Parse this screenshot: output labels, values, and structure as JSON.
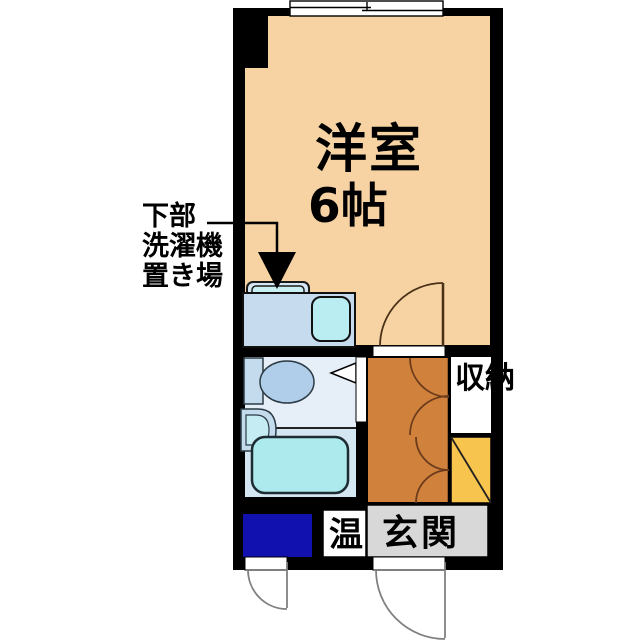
{
  "rooms": {
    "main_room": {
      "name": "洋室",
      "size": "6帖"
    },
    "storage_label": "収納",
    "entrance_label": "玄関",
    "water_heater_label": "温"
  },
  "annotation": {
    "line1": "下部",
    "line2": "洗濯機",
    "line3": "置き場"
  },
  "colors": {
    "wall": "#000000",
    "room_floor": "#F7D3A3",
    "hallway_floor": "#D0813C",
    "shoe_cabinet": "#F7C44D",
    "doormat": "#1111AF",
    "entrance_floor": "#D8D8D8",
    "counter": "#C7DBEE",
    "sink": "#B9EDF1",
    "washer": "#C9EFF2",
    "washer_pan": "#D5E7F2",
    "bathroom_upper": "#E6EFF7",
    "bathroom_lower": "#D3E6F1",
    "bathtub": "#ACEAEE",
    "toilet_bowl": "#B0CDE9",
    "toilet_tank": "#C3DBEC",
    "basin_inner": "#C5ECF2",
    "window_fill": "#FFFFFF",
    "door_line": "#4A3017",
    "closet_door_line": "#6B3B1C",
    "exterior_door_line": "#808080"
  }
}
